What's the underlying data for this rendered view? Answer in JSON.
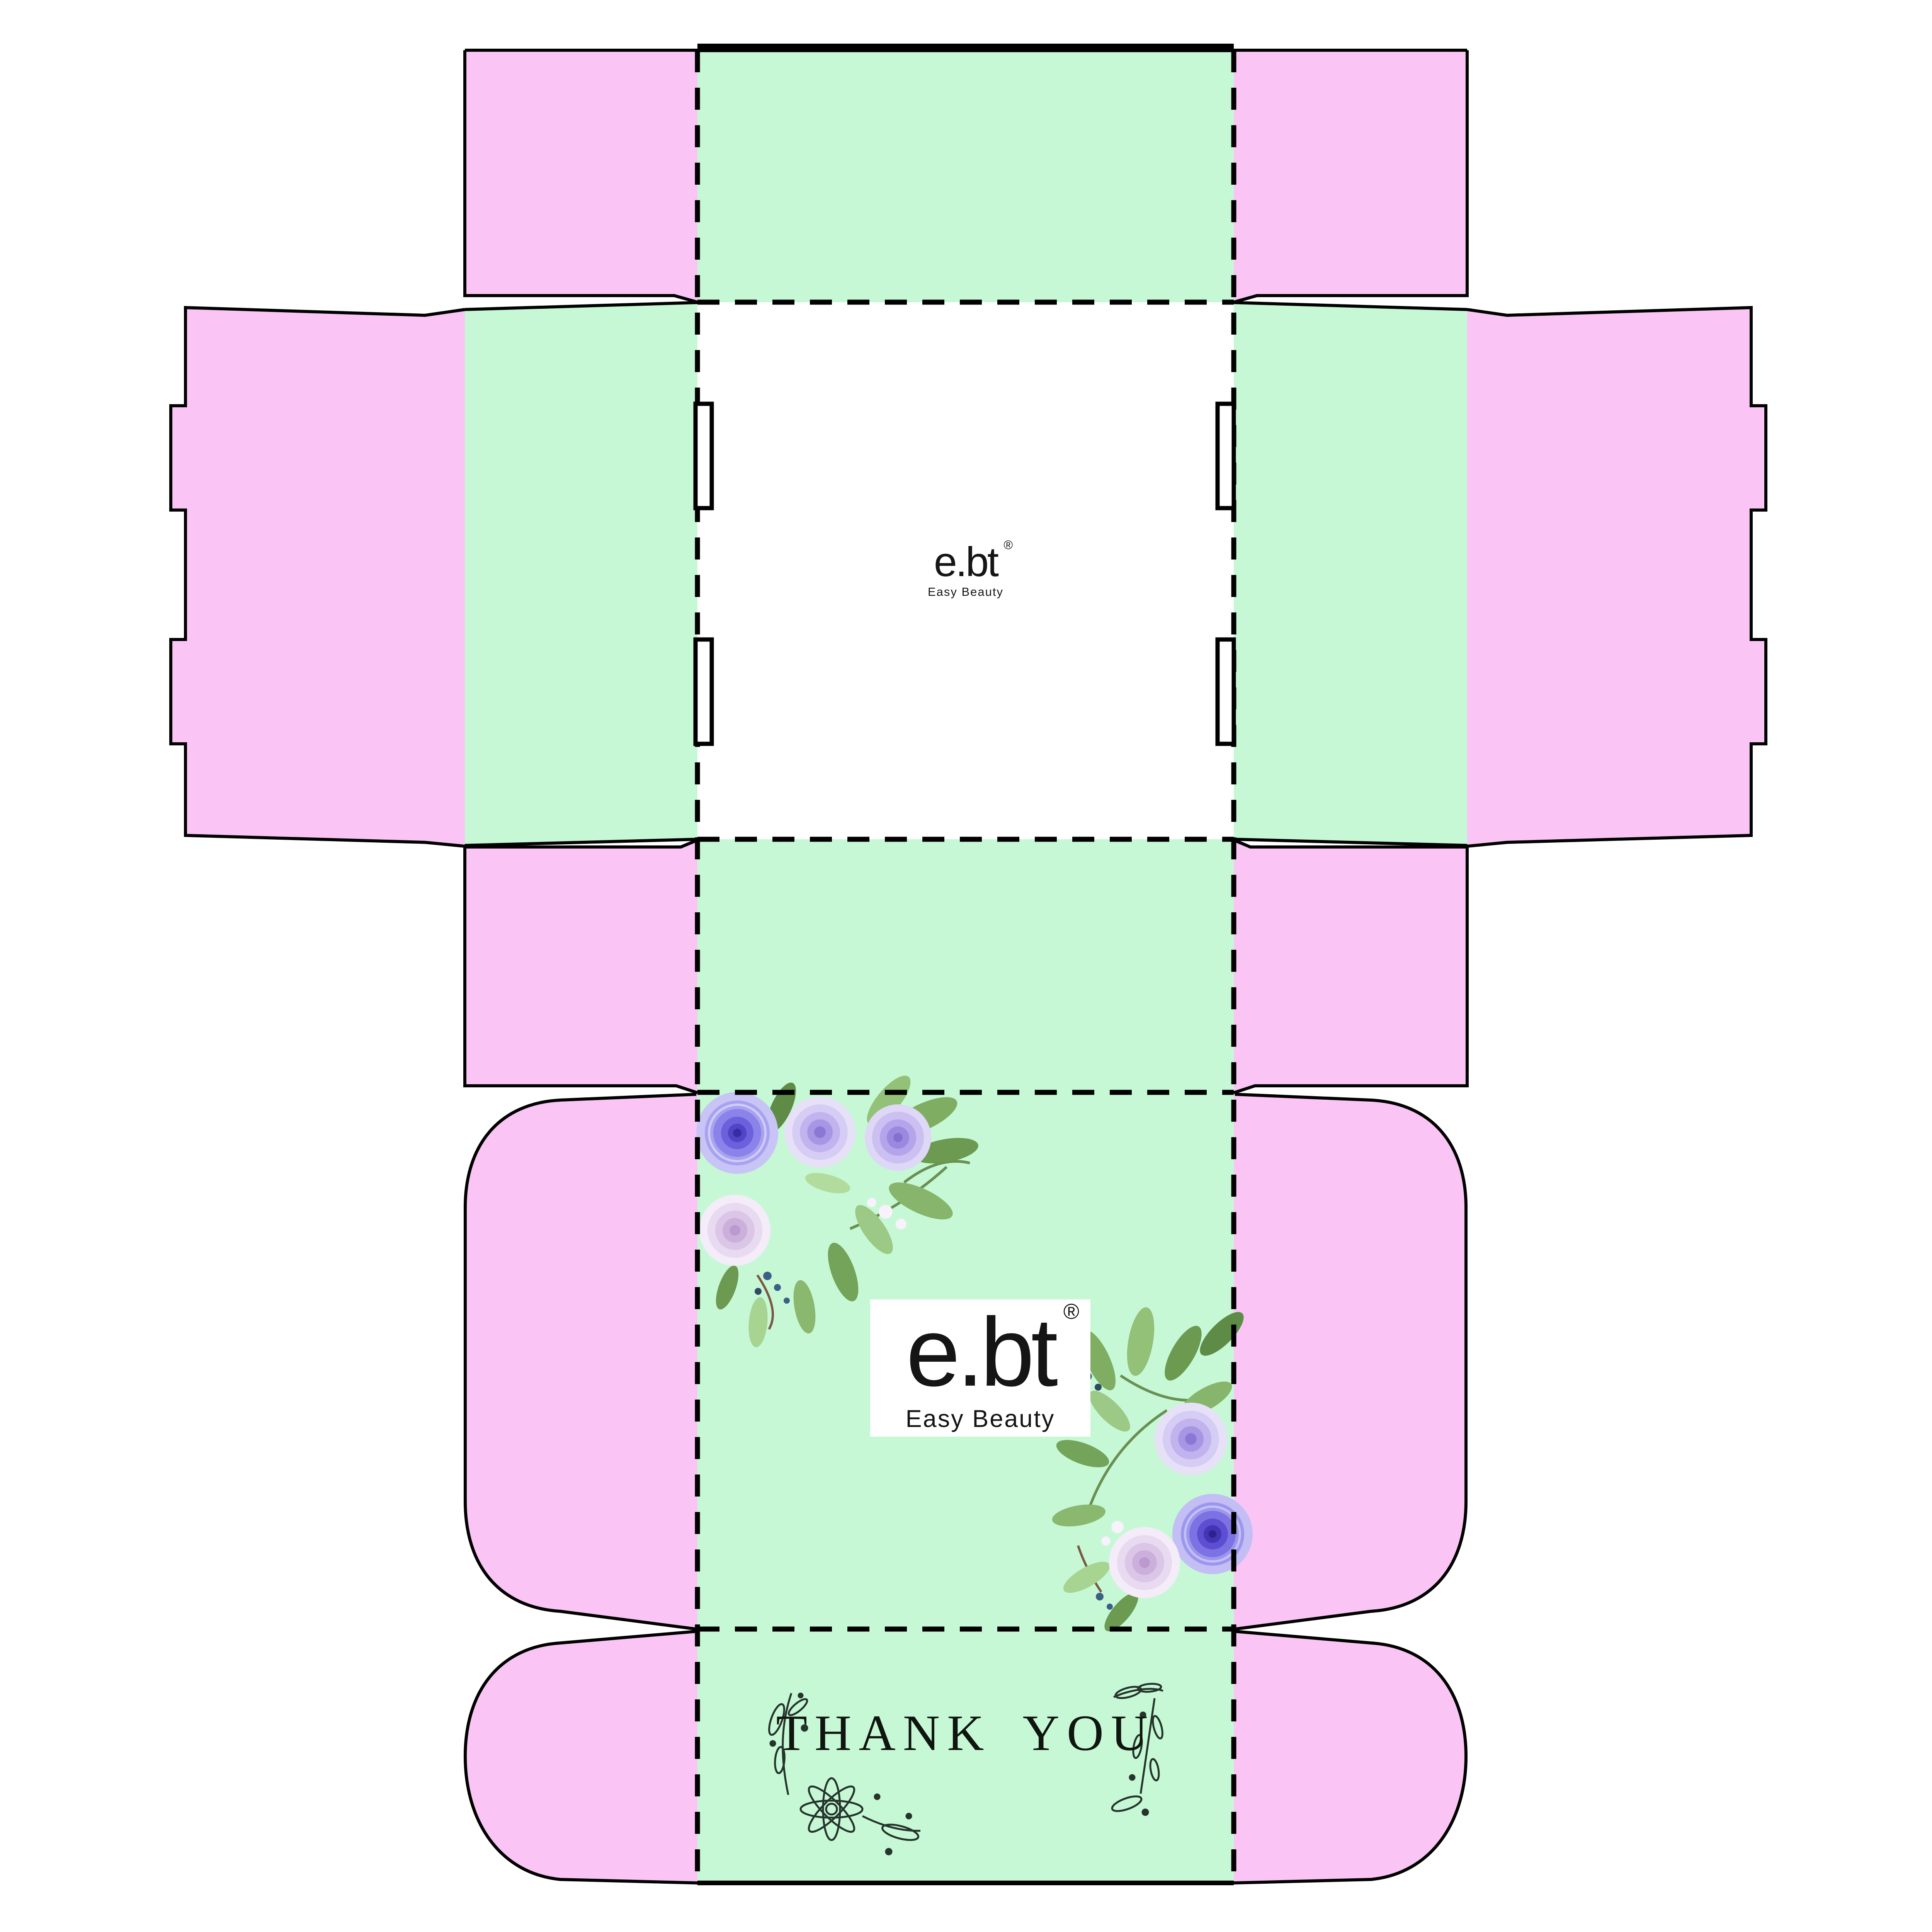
{
  "brand": {
    "logo": "e.bt",
    "registered_mark": "®",
    "tagline": "Easy Beauty"
  },
  "messages": {
    "thank_you": "THANK YOU"
  },
  "colors": {
    "pink_flap": "#FAC5F5",
    "mint_panel": "#C6F8D6",
    "panel_white": "#FFFFFF",
    "cut_line": "#000000",
    "ornament_ink": "#26342C",
    "rose_purple": "#6C60DC",
    "rose_deep_purple": "#4335B4",
    "rose_lavender": "#D6CDF5",
    "rose_blush": "#E8DAF0",
    "leaf_green": "#7FAE63",
    "berry_blue": "#3C5F86"
  },
  "icons": {
    "bouquet_top_left": "rose-bouquet-icon",
    "bouquet_bottom_right": "rose-bouquet-icon",
    "daisy": "daisy-flower-icon",
    "branches": "botanical-branch-icon"
  }
}
